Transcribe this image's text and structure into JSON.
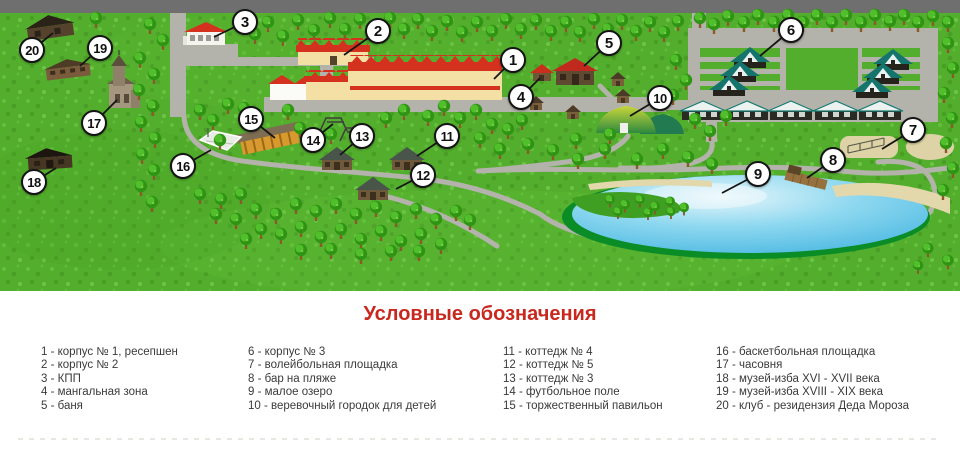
{
  "map": {
    "colors": {
      "grass": "#54ae2d",
      "road": "#b3b3ab",
      "top_road": "#6f6f6f",
      "lake_rim": "#0a8c26",
      "sand": "#e2d8ac",
      "roof_red": "#d5311f",
      "marker_bg": "#ffffff",
      "marker_border": "#141414",
      "title_red": "#c8281e"
    },
    "markers": [
      {
        "n": "1",
        "x": 513,
        "y": 60,
        "tx": 494,
        "ty": 79
      },
      {
        "n": "2",
        "x": 378,
        "y": 31,
        "tx": 344,
        "ty": 55
      },
      {
        "n": "3",
        "x": 245,
        "y": 22,
        "tx": 214,
        "ty": 37
      },
      {
        "n": "4",
        "x": 521,
        "y": 97,
        "tx": 540,
        "ty": 78
      },
      {
        "n": "5",
        "x": 609,
        "y": 43,
        "tx": 584,
        "ty": 66
      },
      {
        "n": "6",
        "x": 791,
        "y": 30,
        "tx": 760,
        "ty": 56
      },
      {
        "n": "7",
        "x": 913,
        "y": 130,
        "tx": 882,
        "ty": 149
      },
      {
        "n": "8",
        "x": 833,
        "y": 160,
        "tx": 807,
        "ty": 178
      },
      {
        "n": "9",
        "x": 758,
        "y": 174,
        "tx": 722,
        "ty": 193
      },
      {
        "n": "10",
        "x": 660,
        "y": 98,
        "tx": 630,
        "ty": 116
      },
      {
        "n": "11",
        "x": 447,
        "y": 136,
        "tx": 417,
        "ty": 156
      },
      {
        "n": "12",
        "x": 423,
        "y": 175,
        "tx": 396,
        "ty": 189
      },
      {
        "n": "13",
        "x": 362,
        "y": 136,
        "tx": 340,
        "ty": 155
      },
      {
        "n": "14",
        "x": 313,
        "y": 140,
        "tx": 333,
        "ty": 124
      },
      {
        "n": "15",
        "x": 251,
        "y": 119,
        "tx": 275,
        "ty": 138
      },
      {
        "n": "16",
        "x": 183,
        "y": 166,
        "tx": 211,
        "ty": 150
      },
      {
        "n": "17",
        "x": 94,
        "y": 123,
        "tx": 117,
        "ty": 100
      },
      {
        "n": "18",
        "x": 34,
        "y": 182,
        "tx": 56,
        "ty": 168
      },
      {
        "n": "19",
        "x": 100,
        "y": 48,
        "tx": 80,
        "ty": 66
      },
      {
        "n": "20",
        "x": 32,
        "y": 50,
        "tx": 53,
        "ty": 33
      }
    ]
  },
  "legend": {
    "title": "Условные обозначения",
    "columns": [
      [
        "1 - корпус № 1, ресепшен",
        "2 - корпус № 2",
        "3 - КПП",
        "4 - мангальная зона",
        "5 - баня"
      ],
      [
        "6 - корпус № 3",
        "7 - волейбольная площадка",
        "8 - бар на пляже",
        "9 - малое озеро",
        "10 - веревочный городок для детей"
      ],
      [
        "11 - коттедж № 4",
        "12 - коттедж № 5",
        "13 - коттедж № 3",
        "14 - футбольное поле",
        "15 - торжественный павильон"
      ],
      [
        "16 - баскетбольная площадка",
        "17 - часовня",
        "18 - музей-изба XVI - XVII века",
        "19 - музей-изба XVIII - XIX века",
        "20 - клуб - резидензия Деда Мороза"
      ]
    ]
  }
}
